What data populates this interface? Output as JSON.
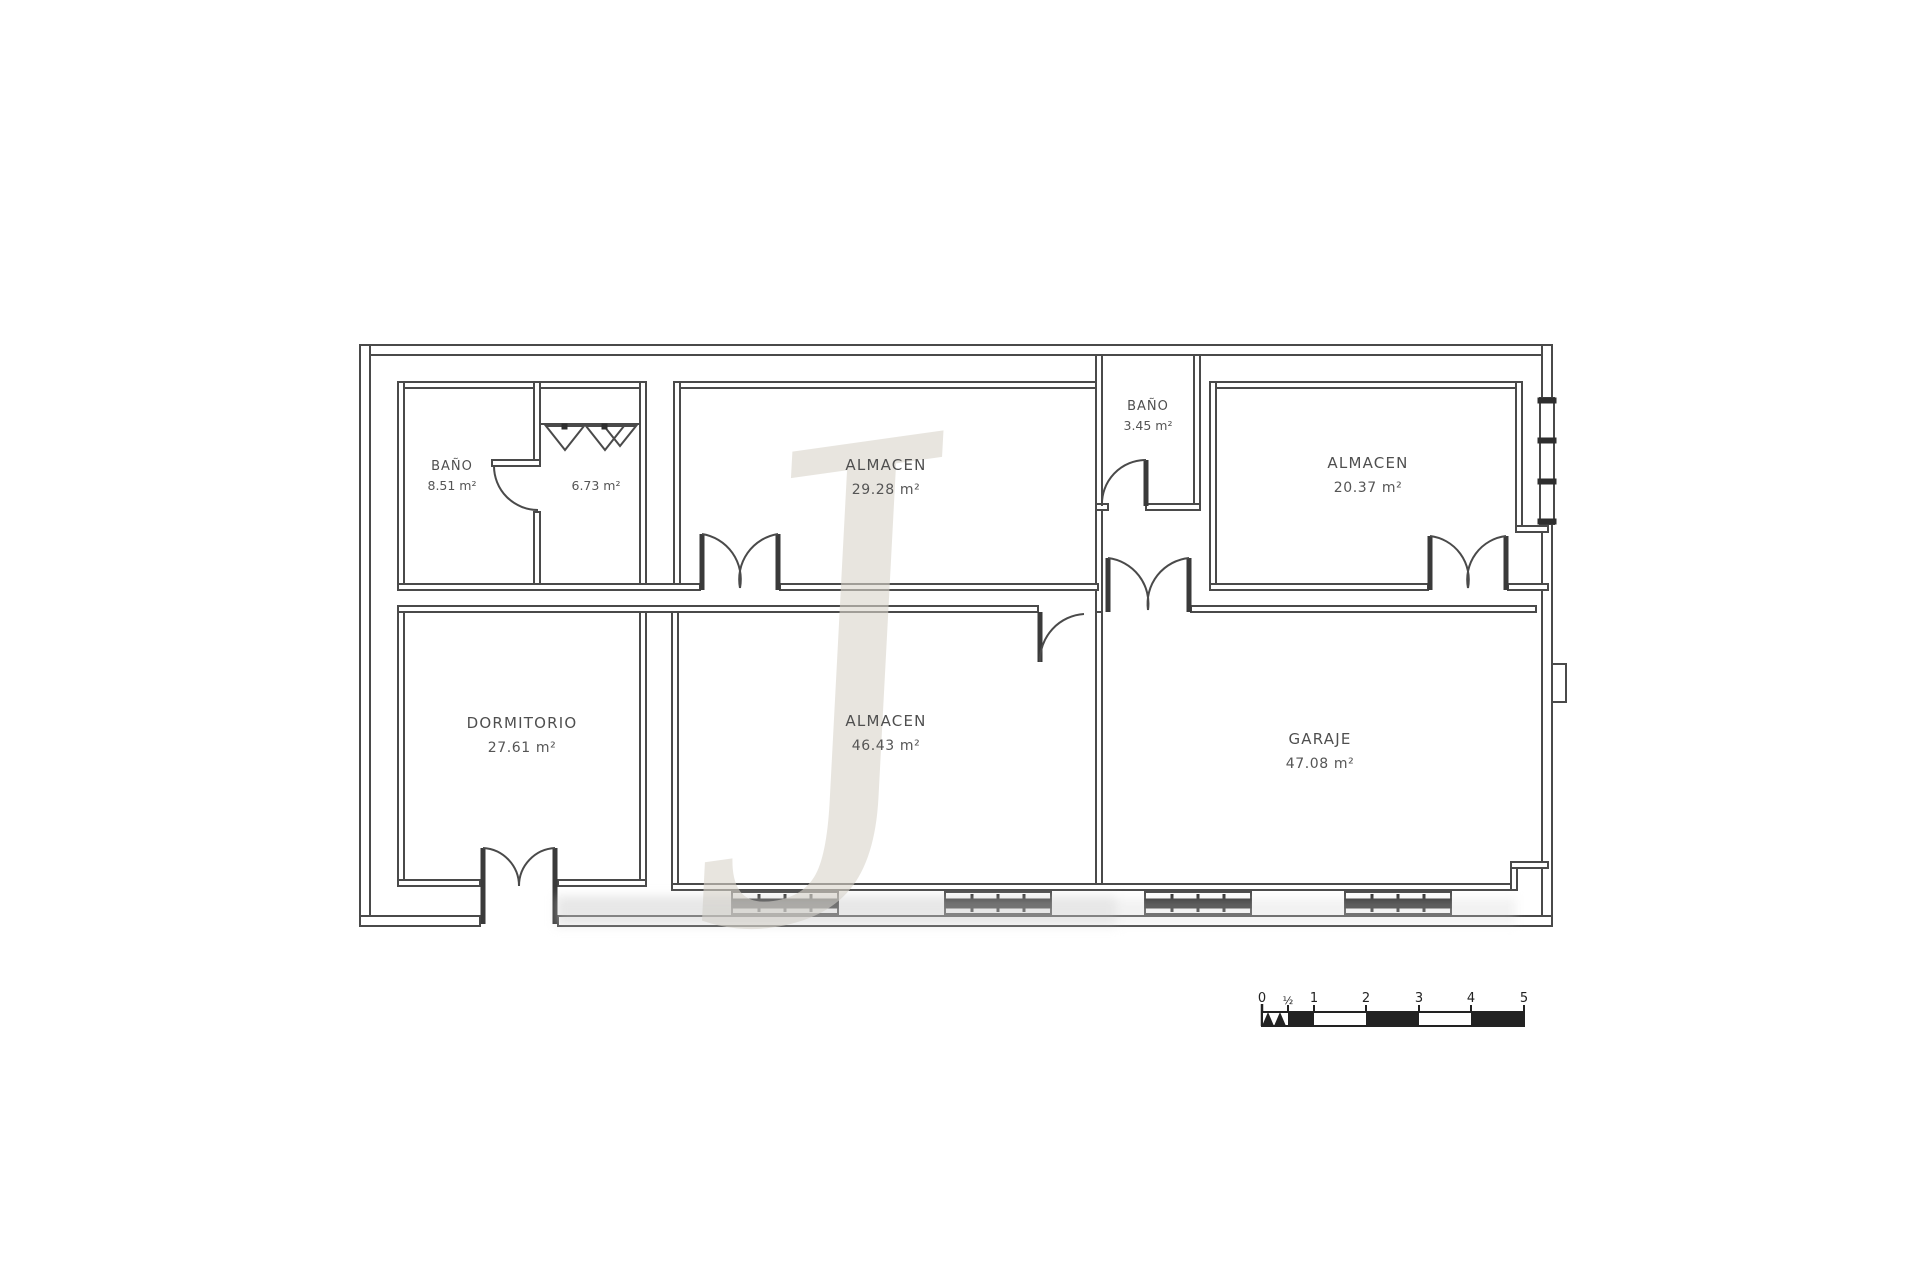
{
  "plan": {
    "type_label": "floor-plan",
    "rooms": [
      {
        "name": "BAÑO",
        "area": "8.51 m²"
      },
      {
        "name": "",
        "area": "6.73 m²"
      },
      {
        "name": "ALMACEN",
        "area": "29.28 m²"
      },
      {
        "name": "BAÑO",
        "area": "3.45 m²"
      },
      {
        "name": "ALMACEN",
        "area": "20.37 m²"
      },
      {
        "name": "DORMITORIO",
        "area": "27.61 m²"
      },
      {
        "name": "ALMACEN",
        "area": "46.43 m²"
      },
      {
        "name": "GARAJE",
        "area": "47.08 m²"
      }
    ],
    "watermark_letter": "J",
    "scale_bar": {
      "labels": [
        "0",
        "½",
        "1",
        "2",
        "3",
        "4",
        "5"
      ]
    }
  },
  "colors": {
    "wall": "#4a4a4a",
    "dark_fill": "#2e2e2e",
    "label_text": "#4f4f4f",
    "watermark": "#d9d5cb",
    "background": "#ffffff"
  }
}
